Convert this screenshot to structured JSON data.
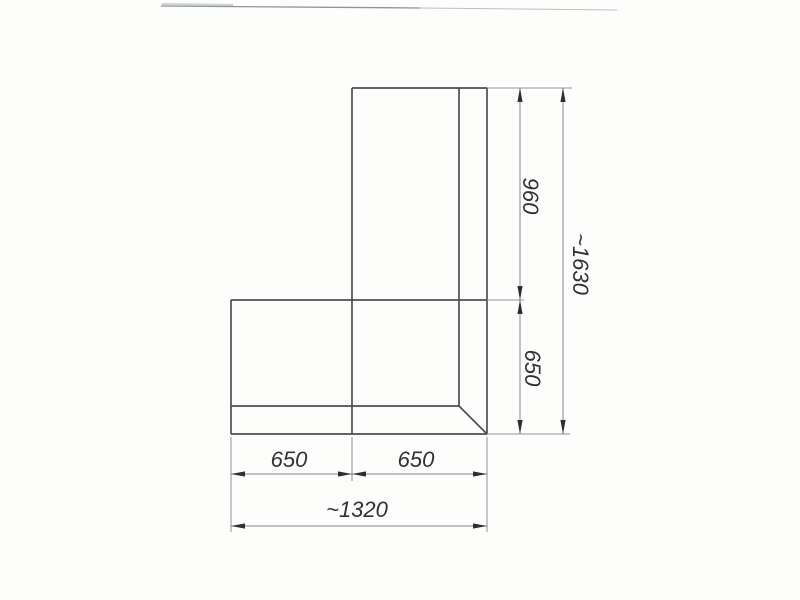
{
  "diagram": {
    "dimensions": {
      "right_upper": "960",
      "right_total": "~1630",
      "right_lower": "650",
      "bottom_left": "650",
      "bottom_right": "650",
      "bottom_total": "~1320"
    },
    "colors": {
      "outline": "#4b4f54",
      "dimension_lines": "#84888d",
      "arrowheads": "#2b2f33",
      "text": "#2e3236",
      "background": "#fdfdfc"
    }
  }
}
